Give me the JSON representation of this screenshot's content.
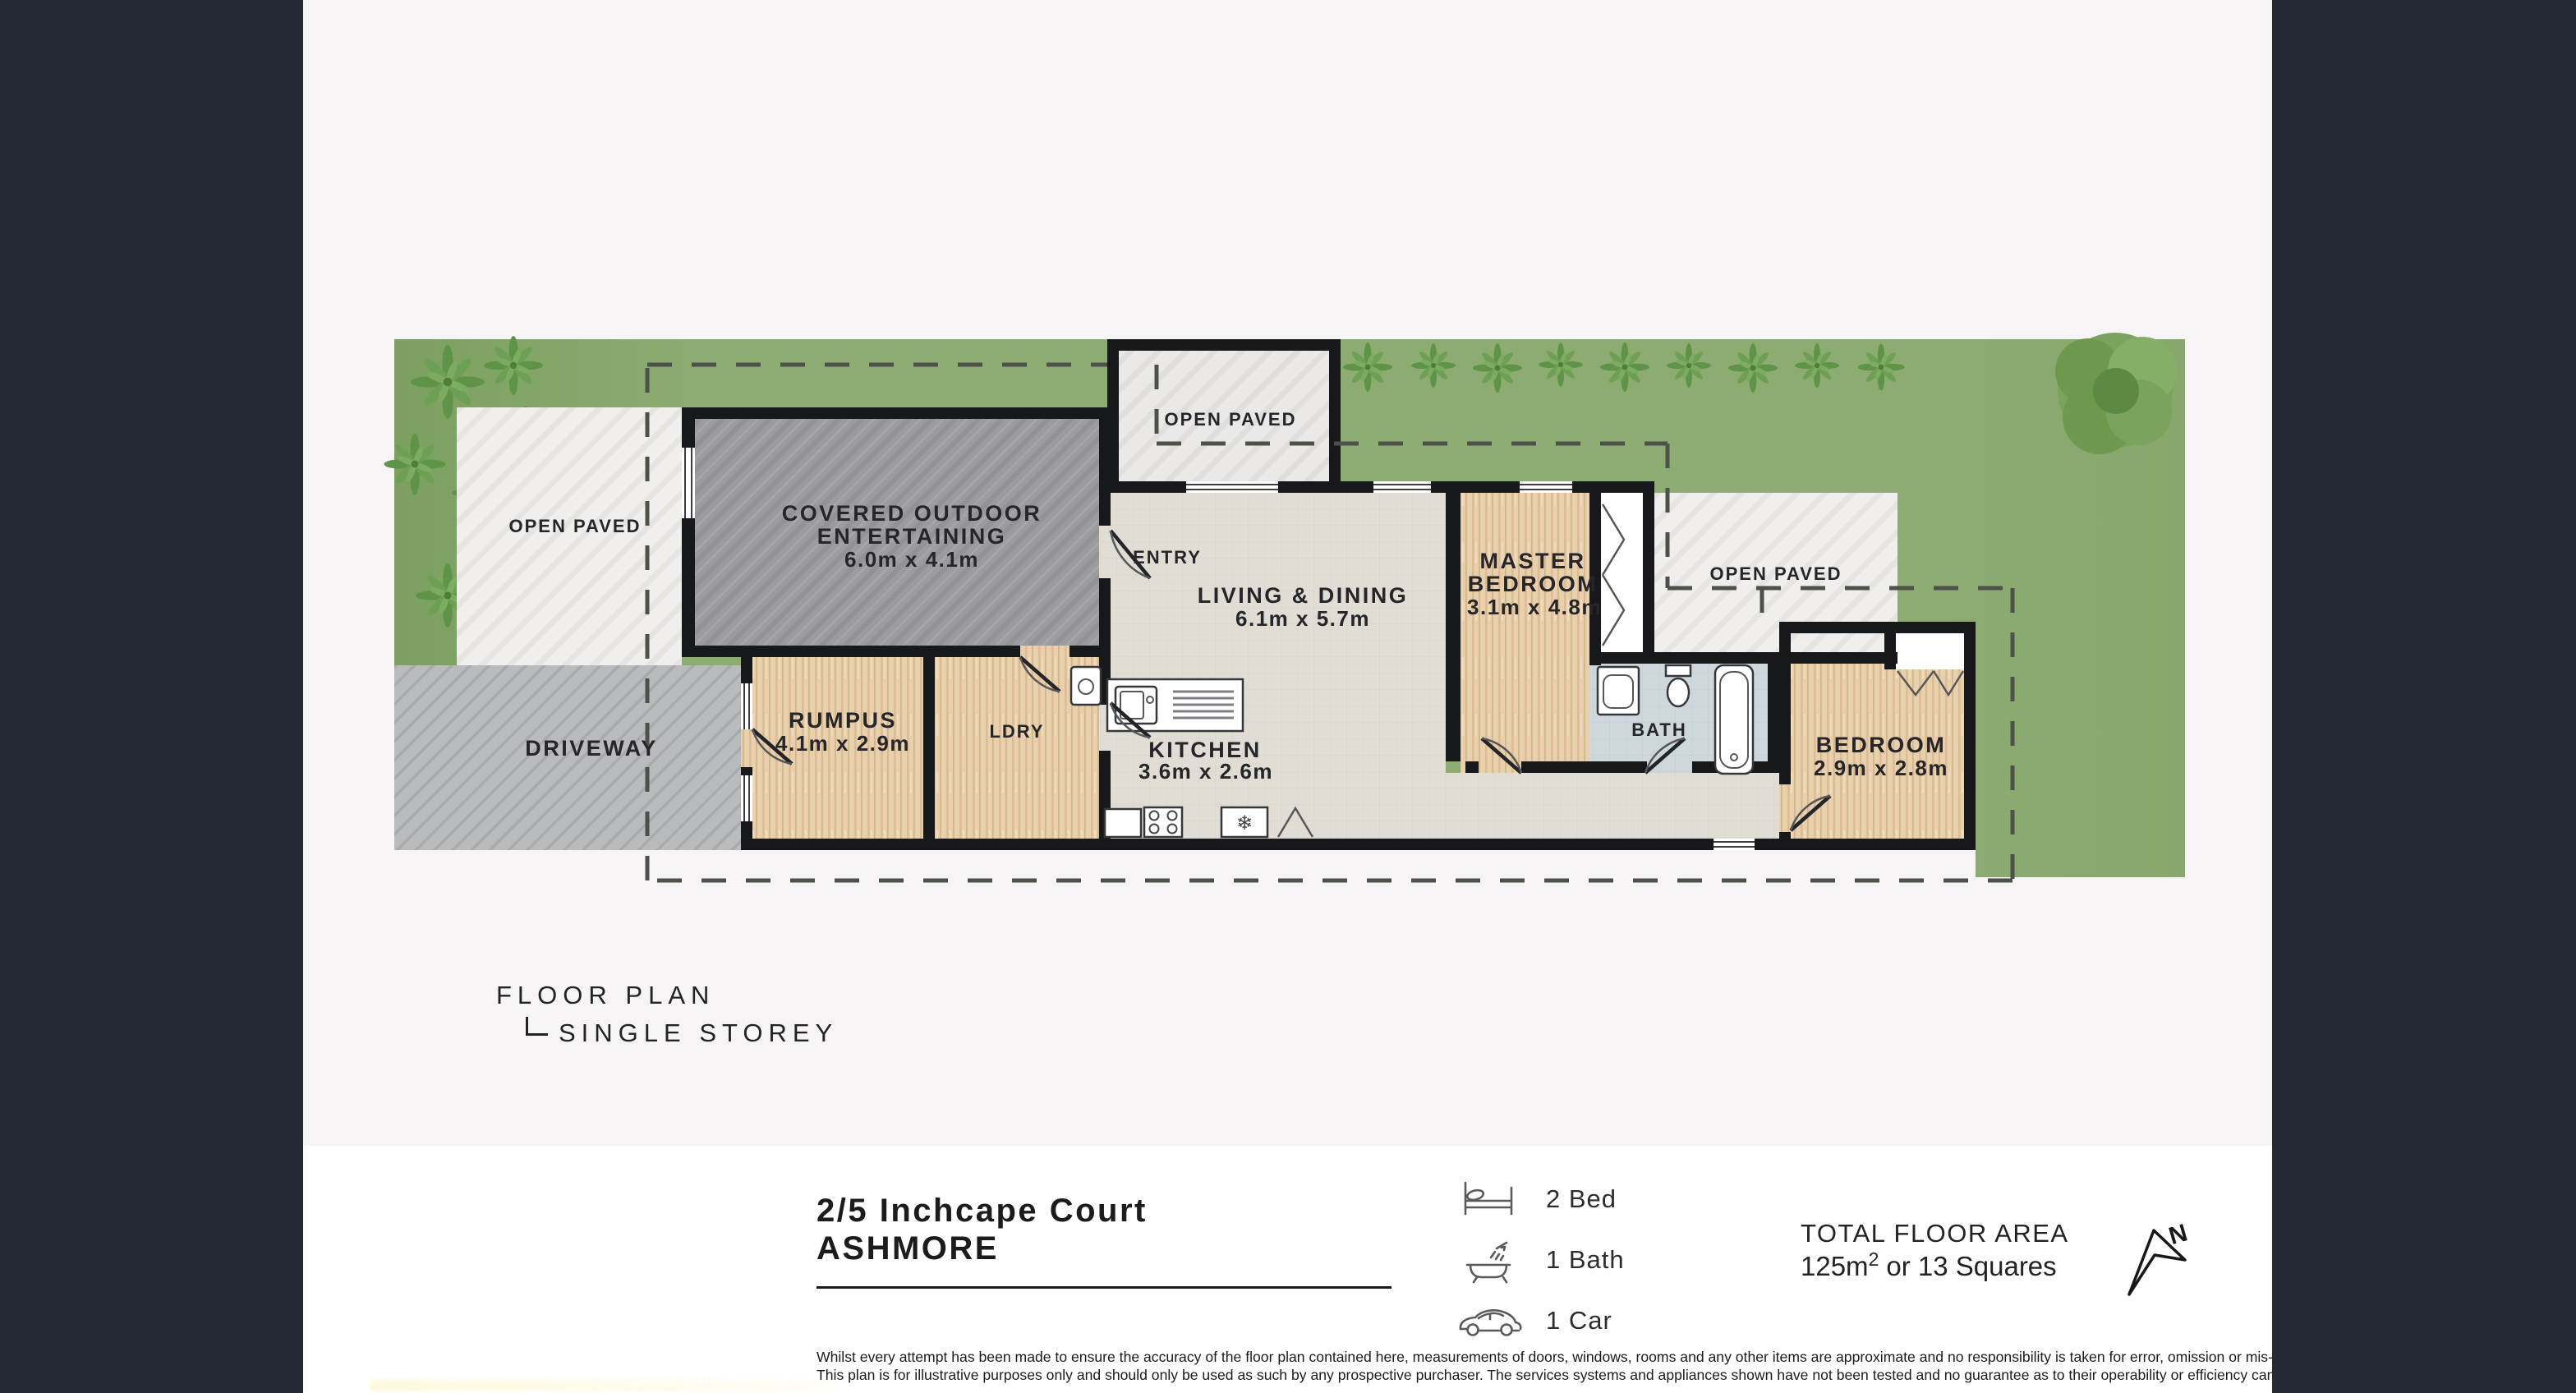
{
  "palette": {
    "sidebar_dark": "#232a32",
    "canvas": "#f6f4f4",
    "footer_bg": "#ffffff",
    "grass": "#8dac72",
    "wall": "#17181b",
    "wood_floor": "#e8d0ac",
    "main_floor": "#e1ddd5",
    "bath_floor": "#cdd7dc",
    "concrete": "#9c9c9f",
    "paving": "#f0efed",
    "driveway": "#b9bbbd"
  },
  "plan": {
    "open_paved_left": "OPEN PAVED",
    "driveway": "DRIVEWAY",
    "covered_line1": "COVERED OUTDOOR",
    "covered_line2": "ENTERTAINING",
    "covered_dims": "6.0m x 4.1m",
    "courtyard": "OPEN PAVED",
    "entry": "ENTRY",
    "living_line1": "LIVING & DINING",
    "living_dims": "6.1m x 5.7m",
    "kitchen_line1": "KITCHEN",
    "kitchen_dims": "3.6m x 2.6m",
    "rumpus_line1": "RUMPUS",
    "rumpus_dims": "4.1m x 2.9m",
    "ldry": "LDRY",
    "master_line1": "MASTER",
    "master_line2": "BEDROOM",
    "master_dims": "3.1m x 4.8m",
    "bath": "BATH",
    "open_paved_right": "OPEN PAVED",
    "bedroom_line1": "BEDROOM",
    "bedroom_dims": "2.9m x 2.8m"
  },
  "legend": {
    "title": "FLOOR PLAN",
    "subtitle": "SINGLE STOREY"
  },
  "footer": {
    "address_line1": "2/5 Inchcape Court",
    "address_line2": "ASHMORE",
    "features": [
      {
        "icon": "bed-icon",
        "label": "2 Bed"
      },
      {
        "icon": "bath-icon",
        "label": "1 Bath"
      },
      {
        "icon": "car-icon",
        "label": "1 Car"
      }
    ],
    "area_title": "TOTAL FLOOR AREA",
    "area_value": "125m",
    "area_sup": "2",
    "area_rest": "or 13 Squares",
    "compass_label": "N",
    "disclaimer_line1": "Whilst every attempt has been made to ensure the accuracy of the floor plan contained here, measurements of doors, windows, rooms and any other items are approximate and no responsibility is taken for error, omission or mis-statement.",
    "disclaimer_line2": "This plan is for illustrative purposes only and should only be used as such by any prospective purchaser. The services systems and appliances shown have not been tested and no guarantee as to their operability or efficiency can be given."
  }
}
